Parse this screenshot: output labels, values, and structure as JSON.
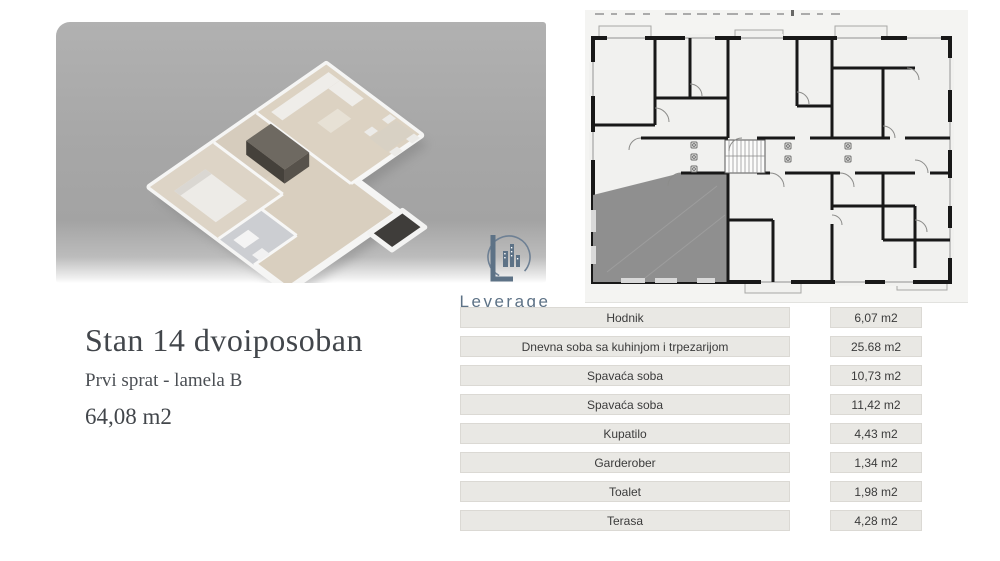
{
  "listing": {
    "title": "Stan 14 dvoiposoban",
    "floor_line": "Prvi sprat - lamela B",
    "total_area": "64,08 m2"
  },
  "brand": {
    "name": "Leverage",
    "tagline": "nekretnine"
  },
  "rooms": {
    "rows": [
      {
        "name": "Hodnik",
        "area": "6,07 m2"
      },
      {
        "name": "Dnevna soba sa kuhinjom i trpezarijom",
        "area": "25.68 m2"
      },
      {
        "name": "Spavaća soba",
        "area": "10,73 m2"
      },
      {
        "name": "Spavaća soba",
        "area": "11,42 m2"
      },
      {
        "name": "Kupatilo",
        "area": "4,43 m2"
      },
      {
        "name": "Garderober",
        "area": "1,34 m2"
      },
      {
        "name": "Toalet",
        "area": "1,98 m2"
      },
      {
        "name": "Terasa",
        "area": "4,28 m2"
      }
    ]
  },
  "colors": {
    "brand_name": "#5d7286",
    "brand_tagline": "#47c2b5",
    "highlighted_unit": "#8f8f8f",
    "plan_wall": "#181818",
    "hero_panel": "#a7a7a7",
    "table_cell_bg": "#e9e8e4",
    "title_text": "#42464b"
  }
}
